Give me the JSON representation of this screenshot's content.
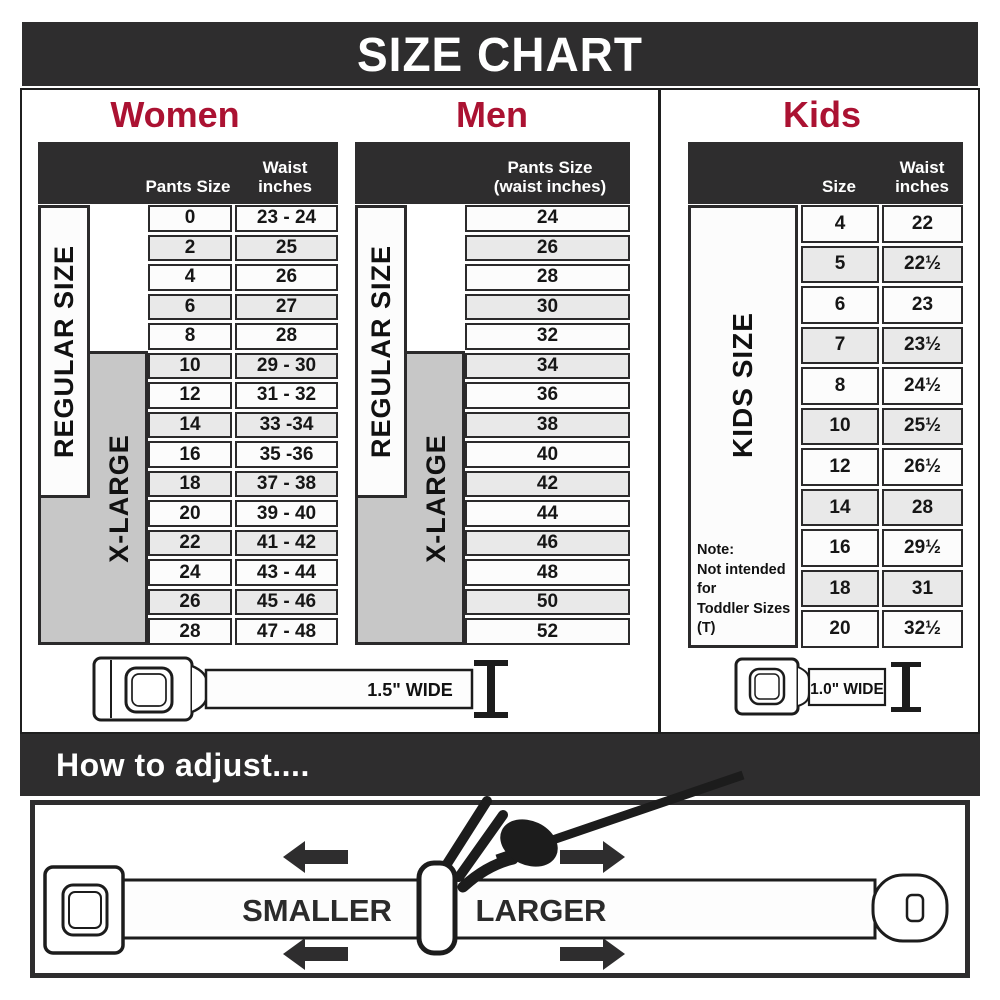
{
  "title": "SIZE CHART",
  "colors": {
    "dark": "#2e2d2e",
    "accent": "#ab1232",
    "row_white": "#fcfcfc",
    "row_gray": "#e9e9e9",
    "xlarge_gray": "#c7c7c7",
    "cell_border": "#2b2a2b"
  },
  "women": {
    "title": "Women",
    "size_header": "Pants Size",
    "waist_header_line1": "Waist",
    "waist_header_line2": "inches",
    "regular_label": "REGULAR SIZE",
    "xlarge_label": "X-LARGE",
    "rows": [
      [
        "0",
        "23 - 24"
      ],
      [
        "2",
        "25"
      ],
      [
        "4",
        "26"
      ],
      [
        "6",
        "27"
      ],
      [
        "8",
        "28"
      ],
      [
        "10",
        "29 - 30"
      ],
      [
        "12",
        "31 - 32"
      ],
      [
        "14",
        "33 -34"
      ],
      [
        "16",
        "35 -36"
      ],
      [
        "18",
        "37 - 38"
      ],
      [
        "20",
        "39 - 40"
      ],
      [
        "22",
        "41 - 42"
      ],
      [
        "24",
        "43 - 44"
      ],
      [
        "26",
        "45 - 46"
      ],
      [
        "28",
        "47 - 48"
      ]
    ]
  },
  "men": {
    "title": "Men",
    "size_header_line1": "Pants Size",
    "size_header_line2": "(waist inches)",
    "regular_label": "REGULAR SIZE",
    "xlarge_label": "X-LARGE",
    "rows": [
      "24",
      "26",
      "28",
      "30",
      "32",
      "34",
      "36",
      "38",
      "40",
      "42",
      "44",
      "46",
      "48",
      "50",
      "52"
    ]
  },
  "kids": {
    "title": "Kids",
    "size_header": "Size",
    "waist_header_line1": "Waist",
    "waist_header_line2": "inches",
    "side_label": "KIDS SIZE",
    "note_lines": [
      "Note:",
      "Not intended for",
      "Toddler Sizes (T)"
    ],
    "rows": [
      [
        "4",
        "22"
      ],
      [
        "5",
        "22½"
      ],
      [
        "6",
        "23"
      ],
      [
        "7",
        "23½"
      ],
      [
        "8",
        "24½"
      ],
      [
        "10",
        "25½"
      ],
      [
        "12",
        "26½"
      ],
      [
        "14",
        "28"
      ],
      [
        "16",
        "29½"
      ],
      [
        "18",
        "31"
      ],
      [
        "20",
        "32½"
      ]
    ]
  },
  "belts": {
    "adult_label": "1.5\" WIDE",
    "kids_label": "1.0\" WIDE"
  },
  "adjust": {
    "title": "How to adjust....",
    "smaller_label": "SMALLER",
    "larger_label": "LARGER"
  }
}
